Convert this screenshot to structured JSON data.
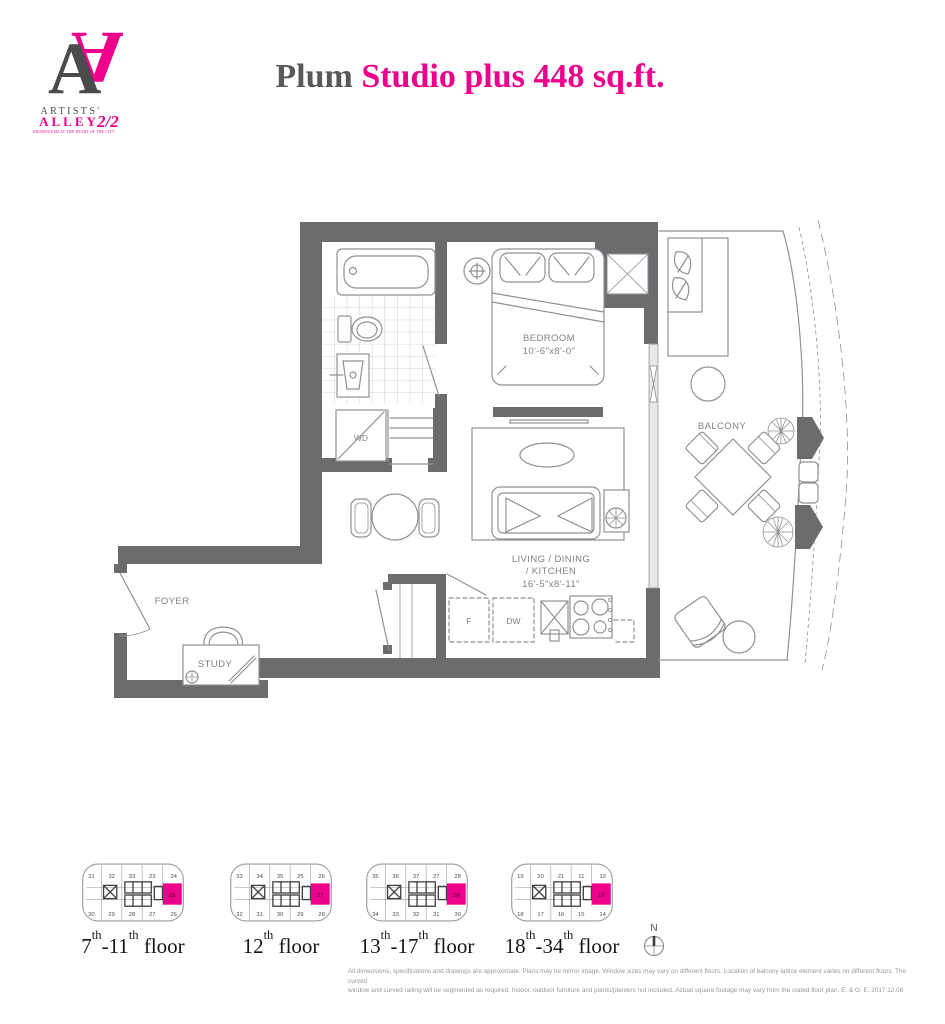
{
  "brand": {
    "monogram": "A",
    "monogram_flipped": "A",
    "name_top": "ARTISTS'",
    "name_bottom": "ALLEY",
    "phase": "2/2",
    "tagline": "CONDOMINIUMS AT THE HEART OF THE CITY"
  },
  "title": {
    "unit_name": "Plum ",
    "descriptor": "Studio plus 448 sq.ft."
  },
  "plan_labels": {
    "bedroom": "BEDROOM",
    "bedroom_dims": "10'-6\"x8'-0\"",
    "living_line1": "LIVING / DINING",
    "living_line2": "/ KITCHEN",
    "living_dims": "16'-5\"x8'-11\"",
    "balcony": "BALCONY",
    "foyer": "FOYER",
    "study": "STUDY",
    "washer_dryer": "WD",
    "fridge": "F",
    "dishwasher": "DW"
  },
  "compass": {
    "north": "N"
  },
  "keyplans": [
    {
      "top": [
        "31",
        "32",
        "33",
        "23",
        "24"
      ],
      "bottom": [
        "30",
        "29",
        "28",
        "27",
        "26"
      ],
      "highlight": "25"
    },
    {
      "top": [
        "33",
        "34",
        "35",
        "25",
        "26"
      ],
      "bottom": [
        "32",
        "31",
        "30",
        "29",
        "28"
      ],
      "highlight": "27"
    },
    {
      "top": [
        "35",
        "36",
        "37",
        "27",
        "28"
      ],
      "bottom": [
        "34",
        "33",
        "32",
        "31",
        "30"
      ],
      "highlight": "29"
    },
    {
      "top": [
        "19",
        "20",
        "21",
        "11",
        "12"
      ],
      "bottom": [
        "18",
        "17",
        "16",
        "15",
        "14"
      ],
      "highlight": "13"
    }
  ],
  "floor_labels": [
    {
      "a": "7",
      "a_sup": "th",
      "b": "-11",
      "b_sup": "th",
      "rest": " floor"
    },
    {
      "a": "12",
      "a_sup": "th",
      "b": "",
      "b_sup": "",
      "rest": " floor"
    },
    {
      "a": "13",
      "a_sup": "th",
      "b": "-17",
      "b_sup": "th",
      "rest": " floor"
    },
    {
      "a": "18",
      "a_sup": "th",
      "b": "-34",
      "b_sup": "th",
      "rest": " floor"
    }
  ],
  "disclaimer": {
    "line1": "All dimensions, specifications and drawings are approximate. Plans may be mirror image. Window sizes may vary on different floors. Location of balcony lattice element varies on different floors. The curved",
    "line2": "window and curved railing will be segmented as required. Indoor, outdoor furniture and plants/planters not included. Actual square footage may vary from the stated floor plan. E. & O. E. 2017.12.08"
  },
  "colors": {
    "accent": "#ec008c",
    "wall": "#6a6c6e",
    "fixture_line": "#8f9194",
    "plan_label": "#808285"
  }
}
